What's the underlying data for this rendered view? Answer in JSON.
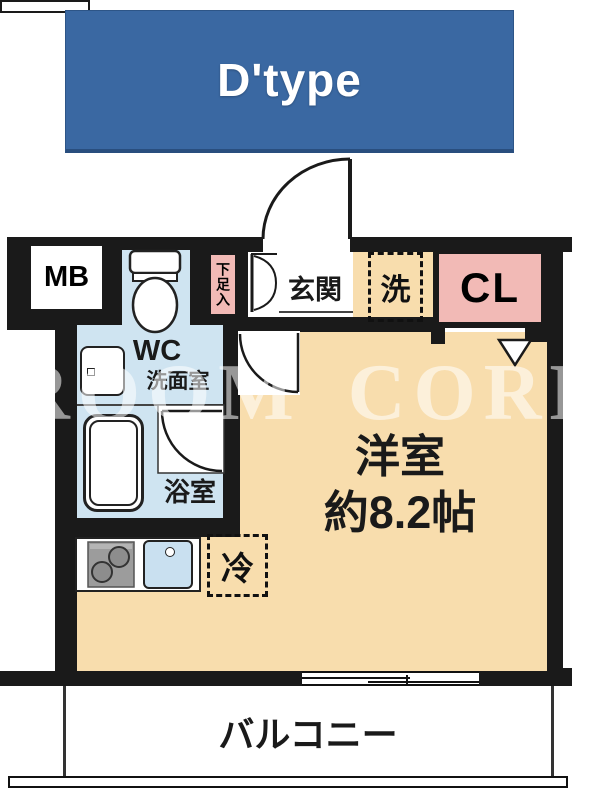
{
  "title": {
    "label": "D'type"
  },
  "watermark": "ROOM CORE",
  "colors": {
    "banner_blue": "#3a68a2",
    "wall_black": "#1a1a1a",
    "room_tan": "#f8ddad",
    "wet_area_blue": "#cfe4f1",
    "closet_pink": "#f2bab6",
    "sink_blue": "#c9e0f0"
  },
  "rooms": {
    "meter_box": "MB",
    "shoe_cabinet": "下足入",
    "entrance": "玄関",
    "washer_space": "洗",
    "closet": "CL",
    "toilet": "WC",
    "washroom": "洗面室",
    "bathroom": "浴室",
    "refrigerator_space": "冷",
    "main_room_name": "洋室",
    "main_room_size": "約8.2帖",
    "balcony": "バルコニー"
  }
}
